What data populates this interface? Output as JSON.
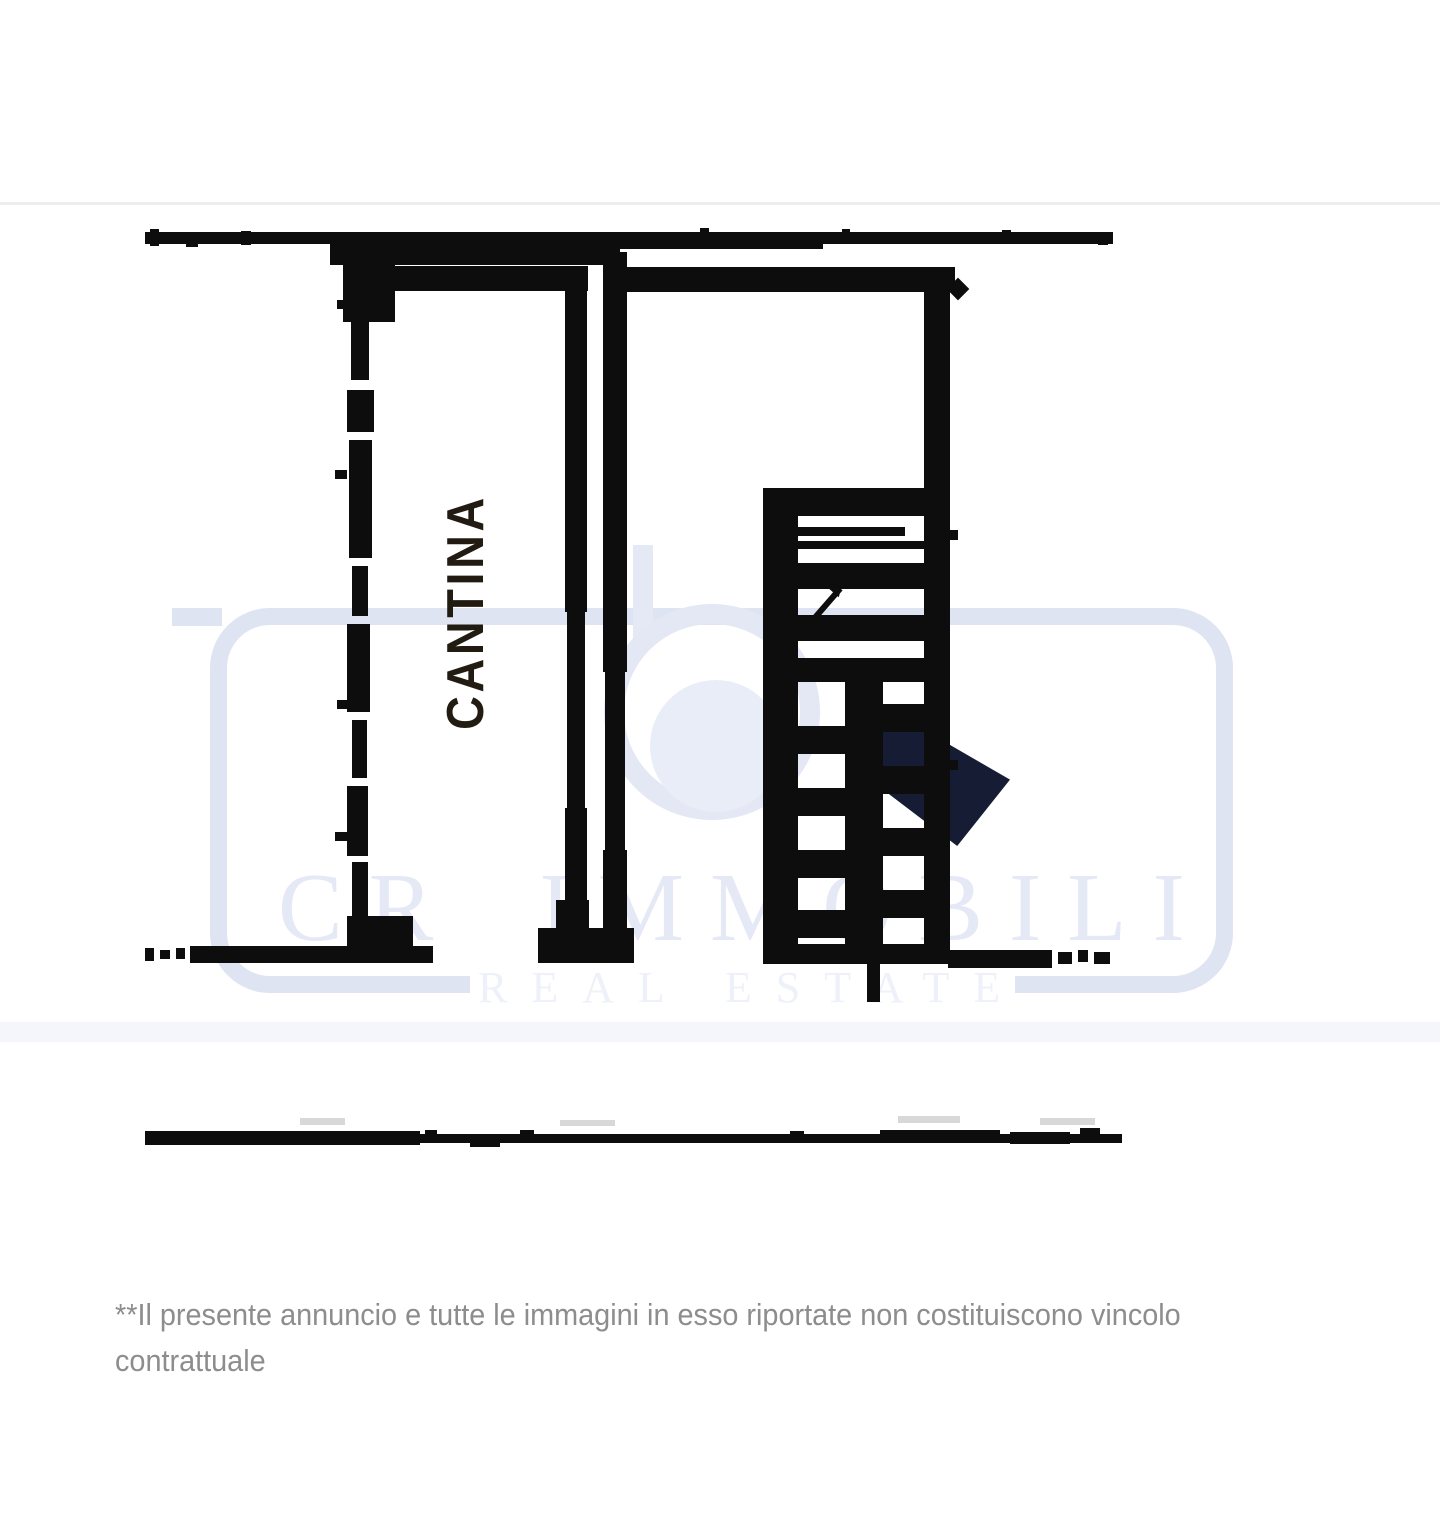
{
  "page": {
    "background_color": "#ffffff",
    "plan_ink_color": "#0d0d0d"
  },
  "floor_plan": {
    "room_label": "CANTINA"
  },
  "watermark": {
    "brand_word1": "CR",
    "brand_word2": "IMMOBILI",
    "sub_word1": "REAL",
    "sub_word2": "ESTATE",
    "border_color": "#dfe4f3",
    "brand_text_color": "#e5e9f6",
    "sub_text_color": "#eef1f9",
    "logo_dark_color": "#161c34"
  },
  "disclaimer": {
    "line1": "**Il presente annuncio e tutte le immagini in esso riportate non costituiscono vincolo",
    "line2": "contrattuale",
    "text_color": "#8d8d8d"
  }
}
